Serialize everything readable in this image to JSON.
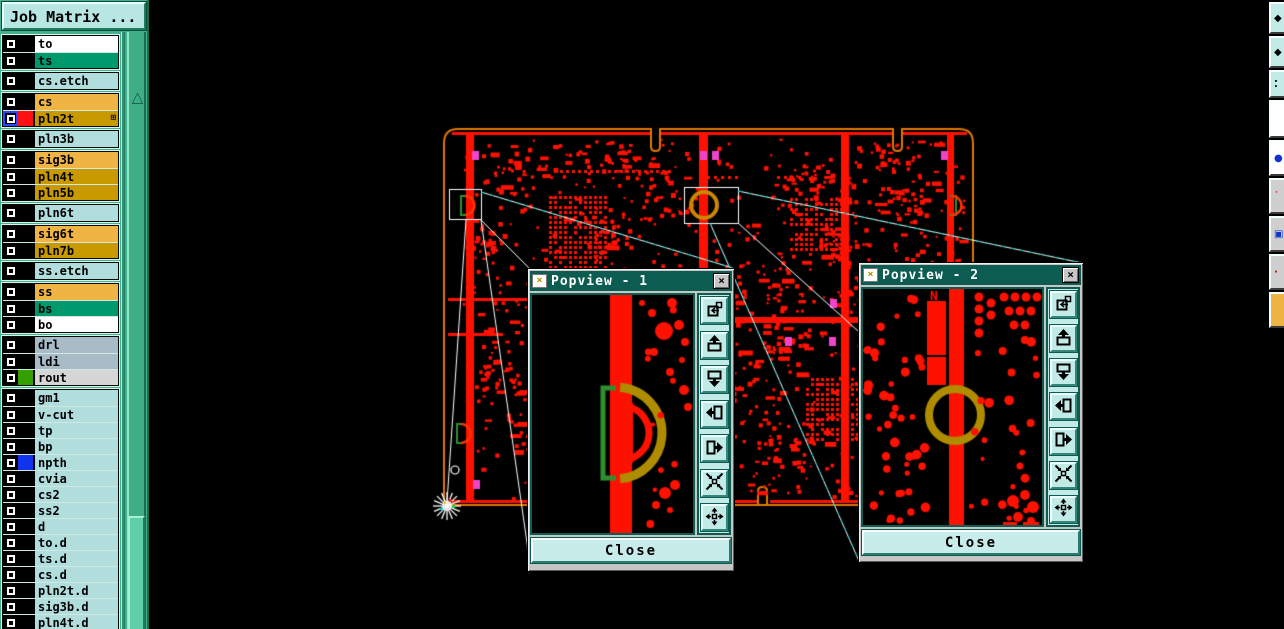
{
  "app": {
    "title": "Job Matrix ..."
  },
  "sidebar": {
    "title": "Job Matrix ...",
    "scroll_up_glyph": "△",
    "groups": [
      {
        "rows": [
          {
            "label": "to",
            "bg": "#ffffff"
          },
          {
            "label": "ts",
            "bg": "#00996e"
          }
        ]
      },
      {
        "rows": [
          {
            "label": "cs.etch",
            "bg": "#b2dddd"
          }
        ]
      },
      {
        "rows": [
          {
            "label": "cs",
            "bg": "#f0b445"
          },
          {
            "label": "pln2t",
            "bg": "#c89a00",
            "swatch": "#ff1111",
            "selected": true,
            "detail": true
          }
        ]
      },
      {
        "rows": [
          {
            "label": "pln3b",
            "bg": "#b2dddd"
          }
        ]
      },
      {
        "rows": [
          {
            "label": "sig3b",
            "bg": "#f0b445"
          },
          {
            "label": "pln4t",
            "bg": "#c89a00"
          },
          {
            "label": "pln5b",
            "bg": "#c89a00"
          }
        ]
      },
      {
        "rows": [
          {
            "label": "pln6t",
            "bg": "#b2dddd"
          }
        ]
      },
      {
        "rows": [
          {
            "label": "sig6t",
            "bg": "#f0b445"
          },
          {
            "label": "pln7b",
            "bg": "#c89a00"
          }
        ]
      },
      {
        "rows": [
          {
            "label": "ss.etch",
            "bg": "#b2dddd"
          }
        ]
      },
      {
        "rows": [
          {
            "label": "ss",
            "bg": "#f0b445"
          },
          {
            "label": "bs",
            "bg": "#00996e"
          },
          {
            "label": "bo",
            "bg": "#ffffff"
          }
        ]
      },
      {
        "rows": [
          {
            "label": "drl",
            "bg": "#a8bcc8"
          },
          {
            "label": "ldi",
            "bg": "#a8bcc8"
          },
          {
            "label": "rout",
            "bg": "#d6d6d6",
            "swatch": "#33a000"
          }
        ]
      },
      {
        "rows": [
          {
            "label": "gm1",
            "bg": "#b2dddd"
          },
          {
            "label": "v-cut",
            "bg": "#b2dddd"
          },
          {
            "label": "tp",
            "bg": "#b2dddd"
          },
          {
            "label": "bp",
            "bg": "#b2dddd"
          },
          {
            "label": "npth",
            "bg": "#b2dddd",
            "swatch": "#1133ee"
          },
          {
            "label": "cvia",
            "bg": "#b2dddd"
          },
          {
            "label": "cs2",
            "bg": "#b2dddd"
          },
          {
            "label": "ss2",
            "bg": "#b2dddd"
          },
          {
            "label": "d",
            "bg": "#b2dddd"
          },
          {
            "label": "to.d",
            "bg": "#b2dddd"
          },
          {
            "label": "ts.d",
            "bg": "#b2dddd"
          },
          {
            "label": "cs.d",
            "bg": "#b2dddd"
          },
          {
            "label": "pln2t.d",
            "bg": "#b2dddd"
          },
          {
            "label": "sig3b.d",
            "bg": "#b2dddd"
          },
          {
            "label": "pln4t.d",
            "bg": "#b2dddd"
          }
        ]
      }
    ]
  },
  "popviews": [
    {
      "title": "Popview - 1",
      "close_label": "Close"
    },
    {
      "title": "Popview - 2",
      "close_label": "Close"
    }
  ],
  "view_toolbar": {
    "buttons": [
      {
        "name": "copy-view-button",
        "icon": "copy-view-icon"
      },
      {
        "name": "pan-up-button",
        "icon": "pan-up-icon"
      },
      {
        "name": "pan-down-button",
        "icon": "pan-down-icon"
      },
      {
        "name": "pan-left-button",
        "icon": "pan-left-icon"
      },
      {
        "name": "pan-right-button",
        "icon": "pan-right-icon"
      },
      {
        "name": "zoom-in-button",
        "icon": "arrows-in-icon"
      },
      {
        "name": "zoom-out-button",
        "icon": "arrows-out-icon"
      }
    ]
  },
  "right_toolbar": {
    "buttons": [
      {
        "name": "side-button-1",
        "bg": "#c2eae6",
        "glyph": "◆",
        "glyph_color": "#000000"
      },
      {
        "name": "side-button-2",
        "bg": "#c2eae6",
        "glyph": "◆",
        "glyph_color": "#000000"
      },
      {
        "name": "side-button-3",
        "bg": "#c2eae6",
        "glyph": "⁚",
        "glyph_color": "#000000"
      },
      {
        "name": "side-button-4",
        "bg": "#ffffff",
        "glyph": "",
        "glyph_color": "#000000"
      },
      {
        "name": "side-button-5",
        "bg": "#ffffff",
        "glyph": "●",
        "glyph_color": "#1133cc"
      },
      {
        "name": "side-button-6",
        "bg": "#cfcfcf",
        "glyph": "˙",
        "glyph_color": "#cc0000"
      },
      {
        "name": "side-button-7",
        "bg": "#cfcfcf",
        "glyph": "▣",
        "glyph_color": "#1133cc"
      },
      {
        "name": "side-button-8",
        "bg": "#cfcfcf",
        "glyph": "·",
        "glyph_color": "#cc0000"
      },
      {
        "name": "side-button-9",
        "bg": "#f0b445",
        "glyph": "",
        "glyph_color": "#000000"
      }
    ]
  },
  "board": {
    "popview2_label": "N",
    "colors": {
      "trace_red": "#ff1100",
      "board_outline": "#e07800",
      "highlight_ring": "#b08c00",
      "pad_magenta": "#ee44cc",
      "callout_white": "#ffffff",
      "select_green": "#2f8f2f",
      "cyan_dash": "#00cccc"
    }
  }
}
